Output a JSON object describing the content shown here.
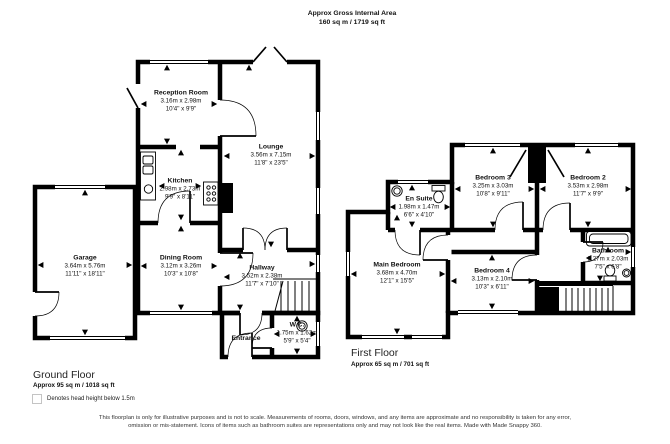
{
  "header": {
    "title": "Approx Gross Internal Area",
    "subtitle": "160 sq m / 1719 sq ft"
  },
  "ground_floor": {
    "title": "Ground Floor",
    "area": "Approx 95 sq m / 1018 sq ft",
    "rooms": {
      "reception": {
        "name": "Reception Room",
        "metric": "3.16m x 2.98m",
        "imperial": "10'4\" x 9'9\""
      },
      "lounge": {
        "name": "Lounge",
        "metric": "3.56m x 7.15m",
        "imperial": "11'8\" x 23'5\""
      },
      "kitchen": {
        "name": "Kitchen",
        "metric": "2.98m x 2.73m",
        "imperial": "9'9\" x 8'11\""
      },
      "garage": {
        "name": "Garage",
        "metric": "3.64m x 5.76m",
        "imperial": "11'11\" x 18'11\""
      },
      "dining": {
        "name": "Dining Room",
        "metric": "3.12m x 3.26m",
        "imperial": "10'3\" x 10'8\""
      },
      "hallway": {
        "name": "Hallway",
        "metric": "3.52m x 2.38m",
        "imperial": "11'7\" x 7'10\""
      },
      "entrance": {
        "name": "Entrance"
      },
      "wc": {
        "name": "W.C.",
        "metric": "1.75m x 1.62m",
        "imperial": "5'9\" x 5'4\""
      }
    }
  },
  "first_floor": {
    "title": "First Floor",
    "area": "Approx 65 sq m / 701 sq ft",
    "rooms": {
      "en_suite": {
        "name": "En Suite",
        "metric": "1.98m x 1.47m",
        "imperial": "6'6\" x 4'10\""
      },
      "bedroom3": {
        "name": "Bedroom 3",
        "metric": "3.25m x 3.03m",
        "imperial": "10'8\" x 9'11\""
      },
      "bedroom2": {
        "name": "Bedroom 2",
        "metric": "3.53m x 2.98m",
        "imperial": "11'7\" x 9'9\""
      },
      "main_bedroom": {
        "name": "Main Bedroom",
        "metric": "3.68m x 4.70m",
        "imperial": "12'1\" x 15'5\""
      },
      "bedroom4": {
        "name": "Bedroom 4",
        "metric": "3.13m x 2.10m",
        "imperial": "10'3\" x 6'11\""
      },
      "bathroom": {
        "name": "Bathroom",
        "metric": "2.27m x 2.03m",
        "imperial": "7'5\" x 6'8\""
      }
    }
  },
  "legend": {
    "label": "Denotes head height below 1.5m"
  },
  "disclaimer": "This floorplan is only for illustrative purposes and is not to scale. Measurements of rooms, doors, windows, and any items are approximate and no responsibility is taken for any error, omission or mis-statement. Icons of items such as bathroom suites are representations only and may not look like the real items. Made with Made Snappy 360.",
  "colors": {
    "wall": "#000000",
    "background": "#ffffff",
    "legend_border": "#c4c4c4"
  }
}
